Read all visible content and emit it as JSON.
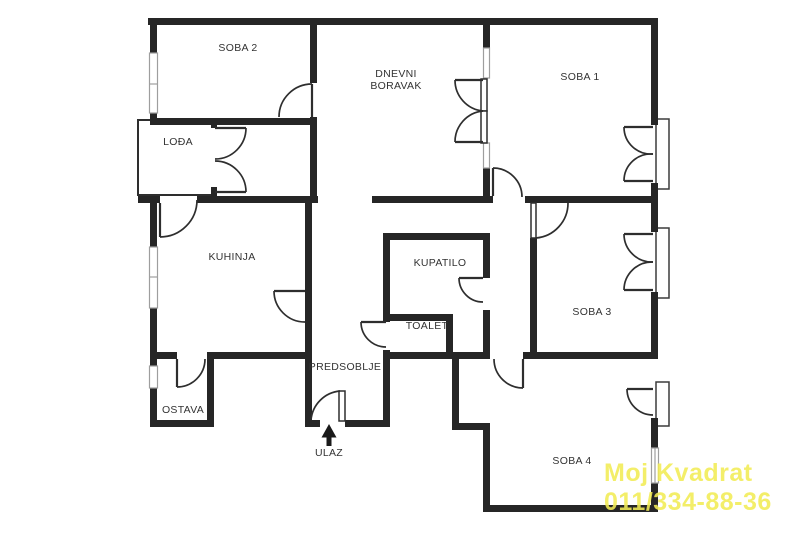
{
  "floorplan": {
    "wall_color": "#262626",
    "label_color": "#333333",
    "rooms": {
      "soba2": "SOBA 2",
      "dnevni_line1": "DNEVNI",
      "dnevni_line2": "BORAVAK",
      "soba1": "SOBA 1",
      "lodja": "LOĐA",
      "kuhinja": "KUHINJA",
      "kupatilo": "KUPATILO",
      "toalet": "TOALET",
      "soba3": "SOBA 3",
      "predsoblje": "PREDSOBLJE",
      "ostava": "OSTAVA",
      "soba4": "SOBA 4"
    },
    "entrance": {
      "label": "ULAZ"
    },
    "watermark": {
      "line1": "Moj Kvadrat",
      "line2": "011/334-88-36",
      "color": "#f2ec55"
    }
  }
}
